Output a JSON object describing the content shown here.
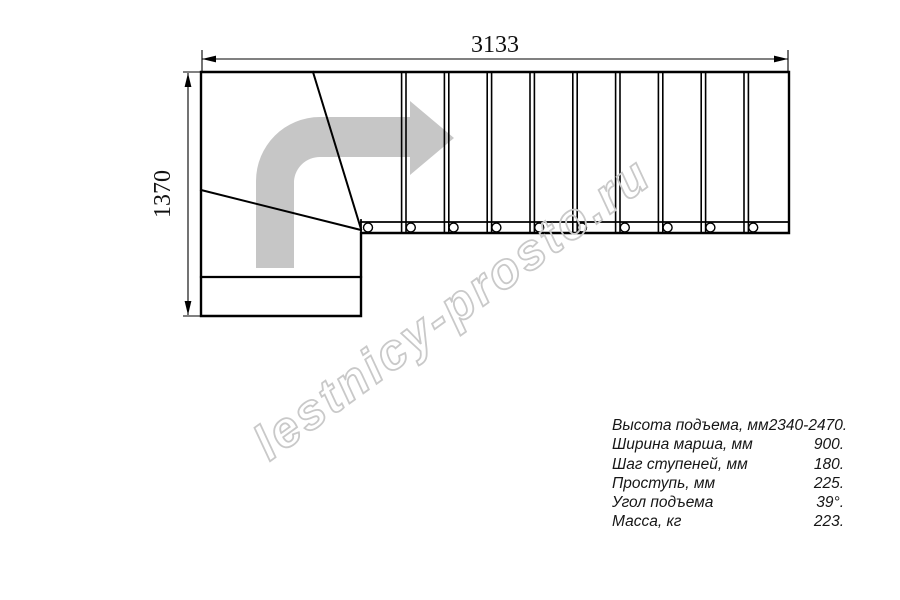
{
  "drawing": {
    "length_label": "3133",
    "width_label": "1370",
    "straight_steps": 10,
    "baluster_count": 10,
    "winder_steps": 2,
    "arrow_color": "#c6c6c6",
    "line_color": "#000000",
    "direction_arrow_icon": "quarter-turn-right-arrow"
  },
  "watermark": {
    "text": "lestnicy-prosto.ru",
    "color": "#c9c9c9"
  },
  "specs": {
    "rows": [
      {
        "label": "Высота подъема, мм",
        "value": "2340-2470."
      },
      {
        "label": "Ширина марша, мм",
        "value": "900."
      },
      {
        "label": "Шаг ступеней, мм",
        "value": "180."
      },
      {
        "label": "Проступь, мм",
        "value": "225."
      },
      {
        "label": "Угол подъема",
        "value": "39°."
      },
      {
        "label": "Масса, кг",
        "value": "223."
      }
    ]
  }
}
